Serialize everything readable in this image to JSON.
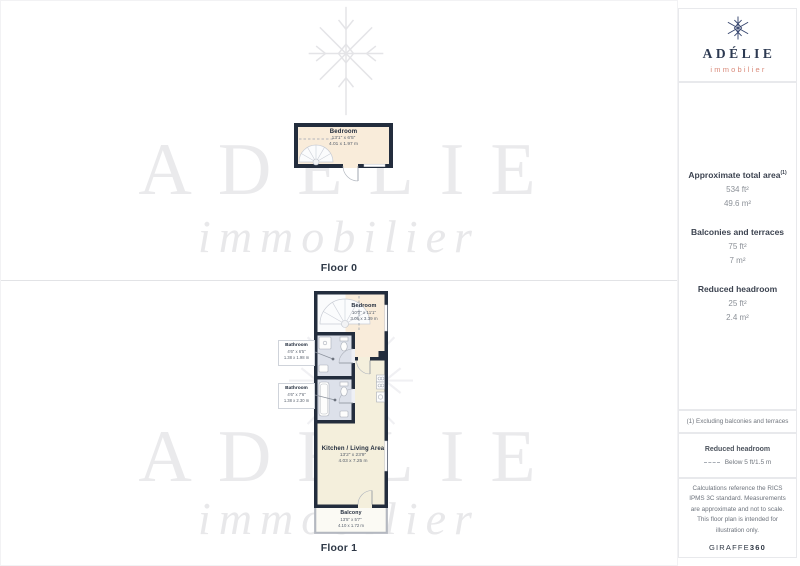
{
  "brand": {
    "name": "ADÉLIE",
    "tagline": "immobilier"
  },
  "watermark": {
    "name": "ADÉLIE",
    "tagline": "immobilier"
  },
  "floor0": {
    "label": "Floor 0",
    "bedroom": {
      "name": "Bedroom",
      "ft": "13'1\" x 6'5\"",
      "m": "4.01 x 1.97 m"
    }
  },
  "floor1": {
    "label": "Floor 1",
    "bedroom": {
      "name": "Bedroom",
      "ft": "10'0\" x 11'1\"",
      "m": "3.06 x 3.39 m"
    },
    "bathroom1": {
      "name": "Bathroom",
      "ft": "4'6\" x 6'5\"",
      "m": "1.38 x 1.98 m"
    },
    "bathroom2": {
      "name": "Bathroom",
      "ft": "4'6\" x 7'6\"",
      "m": "1.38 x 2.30 m"
    },
    "kitchen": {
      "name": "Kitchen / Living Area",
      "ft": "13'2\" x 23'9\"",
      "m": "4.03 x 7.25 m"
    },
    "balcony": {
      "name": "Balcony",
      "ft": "13'5\" x 5'7\"",
      "m": "4.10 x 1.72 m"
    }
  },
  "sidebar": {
    "total": {
      "title": "Approximate total area",
      "sup": "(1)",
      "ft": "534 ft²",
      "m": "49.6 m²"
    },
    "balconies": {
      "title": "Balconies and terraces",
      "ft": "75 ft²",
      "m": "7 m²"
    },
    "reduced": {
      "title": "Reduced headroom",
      "ft": "25 ft²",
      "m": "2.4 m²"
    },
    "note": "(1) Excluding balconies and terraces",
    "legend": {
      "title": "Reduced headroom",
      "item": "Below 5 ft/1.5 m"
    },
    "disclaimer": "Calculations reference the RICS IPMS 3C standard. Measurements are approximate and not to scale. This floor plan is intended for illustration only.",
    "brand_name": "GIRAFFE",
    "brand_number": "360"
  },
  "colors": {
    "wall": "#232d3d",
    "bedroom_floor": "#f9ecda",
    "kitchen_floor": "#f4efdc",
    "bathroom_floor": "#dde1ea",
    "balcony_floor": "#fbfaf4",
    "logo_navy": "#2d3a52",
    "logo_coral": "#d98a7a"
  }
}
